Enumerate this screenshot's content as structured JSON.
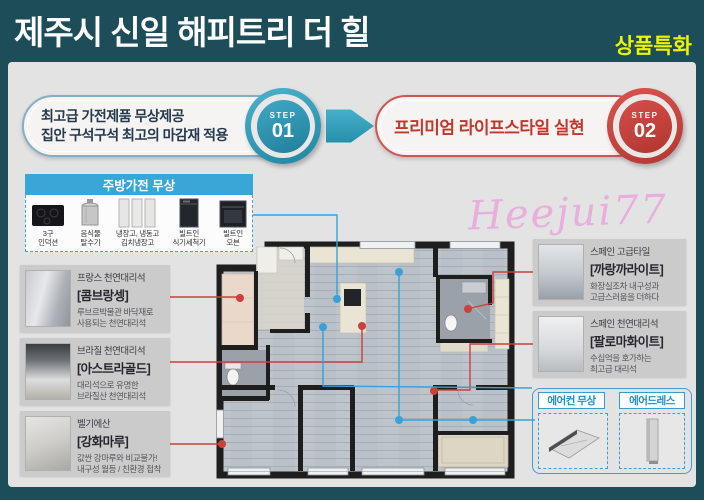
{
  "header": {
    "title": "제주시 신일 해피트리 더 힐",
    "badge": "상품특화"
  },
  "steps": {
    "one": {
      "tag": "STEP",
      "num": "01",
      "line1": "최고급 가전제품 무상제공",
      "line2": "집안 구석구석 최고의 마감재 적용"
    },
    "two": {
      "tag": "STEP",
      "num": "02",
      "line1": "프리미엄 라이프스타일 실현"
    }
  },
  "kitchen": {
    "title": "주방가전 무상",
    "items": [
      {
        "icon": "induction-icon",
        "label": "3구\n인덕션"
      },
      {
        "icon": "food-dehydrator-icon",
        "label": "음식물\n탈수기"
      },
      {
        "icon": "refrigerator-icon",
        "label": "냉장고, 냉동고\n김치냉장고"
      },
      {
        "icon": "dishwasher-icon",
        "label": "빌트인\n식기세척기"
      },
      {
        "icon": "oven-icon",
        "label": "빌트인\n오븐"
      }
    ]
  },
  "materials_left": [
    {
      "origin": "프랑스 천연대리석",
      "name": "[콤브랑셍]",
      "desc": "루브르박물관 바닥재로\n사용되는 천연대리석"
    },
    {
      "origin": "브라질 천연대리석",
      "name": "[아스트라골드]",
      "desc": "대리석으로 유명한\n브라질산 천연대리석"
    },
    {
      "origin": "벨기에산",
      "name": "[강화마루]",
      "desc": "값싼 강마루와 비교불가!\n내구성 월등 / 친환경 접착"
    }
  ],
  "materials_right": [
    {
      "origin": "스페인 고급타일",
      "name": "[까랑까라이트]",
      "desc": "화장실조차 내구성과\n고급스러움을 더하다"
    },
    {
      "origin": "스페인 천연대리석",
      "name": "[팔로마화이트]",
      "desc": "수십억을 호가하는\n최고급 대리석"
    }
  ],
  "free_items": {
    "ac": "에어컨 무상",
    "dresser": "에어드레스"
  },
  "watermark": "Heejui77",
  "colors": {
    "frame_teal": "#1d4d59",
    "panel_grey": "#e3e3e3",
    "accent_blue": "#38a6d6",
    "accent_red": "#c9413c",
    "accent_teal": "#2f96b4",
    "badge_yellow": "#ecf400",
    "watermark_pink": "#e9a9dc"
  }
}
